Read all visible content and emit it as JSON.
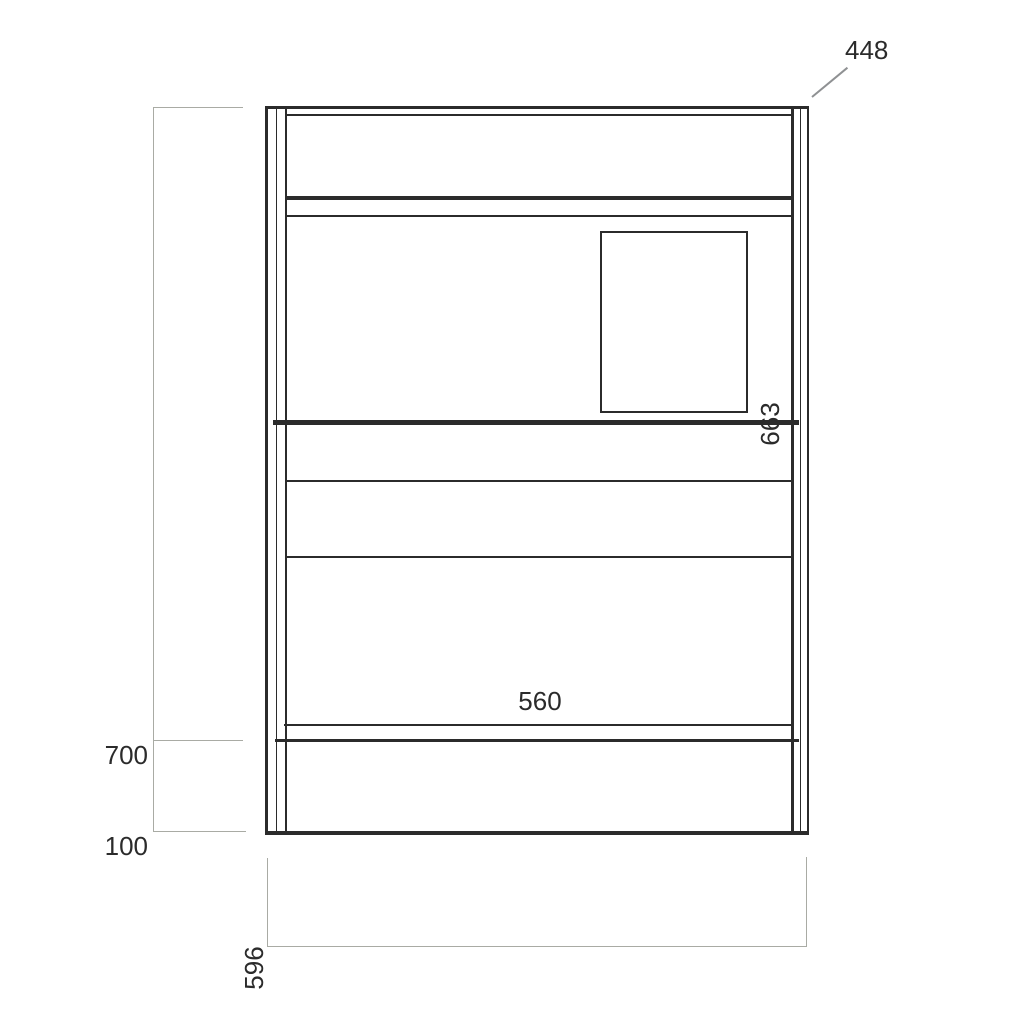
{
  "drawing_title": "cabinet-front-elevation-technical-drawing",
  "colors": {
    "background": "#ffffff",
    "line": "#2b2b2b",
    "dimension_line": "#a9aba4",
    "leader_line": "#8f9193",
    "text": "#2b2b2b"
  },
  "labels": {
    "dim_top_right": "448",
    "dim_right_rotated": "663",
    "dim_center": "560",
    "dim_left_upper": "700",
    "dim_left_lower": "100",
    "dim_bottom_rotated": "596"
  },
  "dimension_values": [
    {
      "value": 448,
      "placement": "top-right with diagonal leader to top-right corner",
      "rotated": false
    },
    {
      "value": 663,
      "placement": "right side, beside middle divider line",
      "rotated": true
    },
    {
      "value": 560,
      "placement": "center, above lower inner line",
      "rotated": false
    },
    {
      "value": 700,
      "placement": "left vertical dimension, upper segment",
      "rotated": false
    },
    {
      "value": 100,
      "placement": "left vertical dimension, lower segment",
      "rotated": false
    },
    {
      "value": 596,
      "placement": "bottom width dimension, left end",
      "rotated": true
    }
  ]
}
